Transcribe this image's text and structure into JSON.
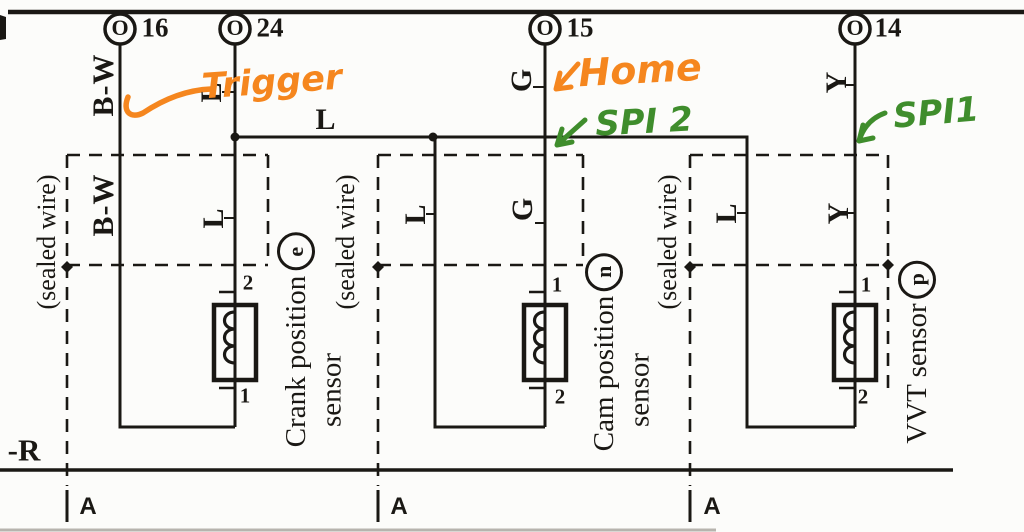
{
  "connectors": {
    "c16": {
      "label": "16",
      "symbol": "O"
    },
    "c24": {
      "label": "24",
      "symbol": "O"
    },
    "c15": {
      "label": "15",
      "symbol": "O"
    },
    "c14": {
      "label": "14",
      "symbol": "O"
    }
  },
  "wire_labels": {
    "bw_top": "B-W",
    "bw_mid": "B-W",
    "l_c24_top": "L",
    "l_branch": "L",
    "l_c24_mid": "L",
    "l_cam_drop": "L",
    "l_vvt_drop": "L",
    "g_top": "G",
    "g_mid": "G",
    "y_top": "Y",
    "y_mid": "Y"
  },
  "sensors": {
    "crank": {
      "name_line1": "Crank position",
      "code": "e",
      "name_line2": "sensor",
      "pin_top": "2",
      "pin_bottom": "1"
    },
    "cam": {
      "name_line1": "Cam position",
      "code": "n",
      "name_line2": "sensor",
      "pin_top": "1",
      "pin_bottom": "2"
    },
    "vvt": {
      "name": "VVT sensor",
      "code": "p",
      "pin_top": "1",
      "pin_bottom": "2"
    }
  },
  "shield_labels": {
    "left": "(sealed wire)",
    "middle": "(sealed wire)",
    "right": "(sealed wire)"
  },
  "bottom": {
    "wire_r": "-R",
    "ground_a1": "A",
    "ground_a2": "A",
    "ground_a3": "A"
  },
  "annotations": {
    "trigger": {
      "text": "Trigger",
      "color": "#F5861E"
    },
    "home": {
      "text": "Home",
      "color": "#F5861E"
    },
    "spi2": {
      "text": "SPI 2",
      "color": "#3F8D2C"
    },
    "spi1": {
      "text": "SPI1",
      "color": "#3F8D2C"
    }
  },
  "colors": {
    "ink": "#1a1814",
    "annotation_orange": "#F5861E",
    "annotation_green": "#3F8D2C"
  }
}
